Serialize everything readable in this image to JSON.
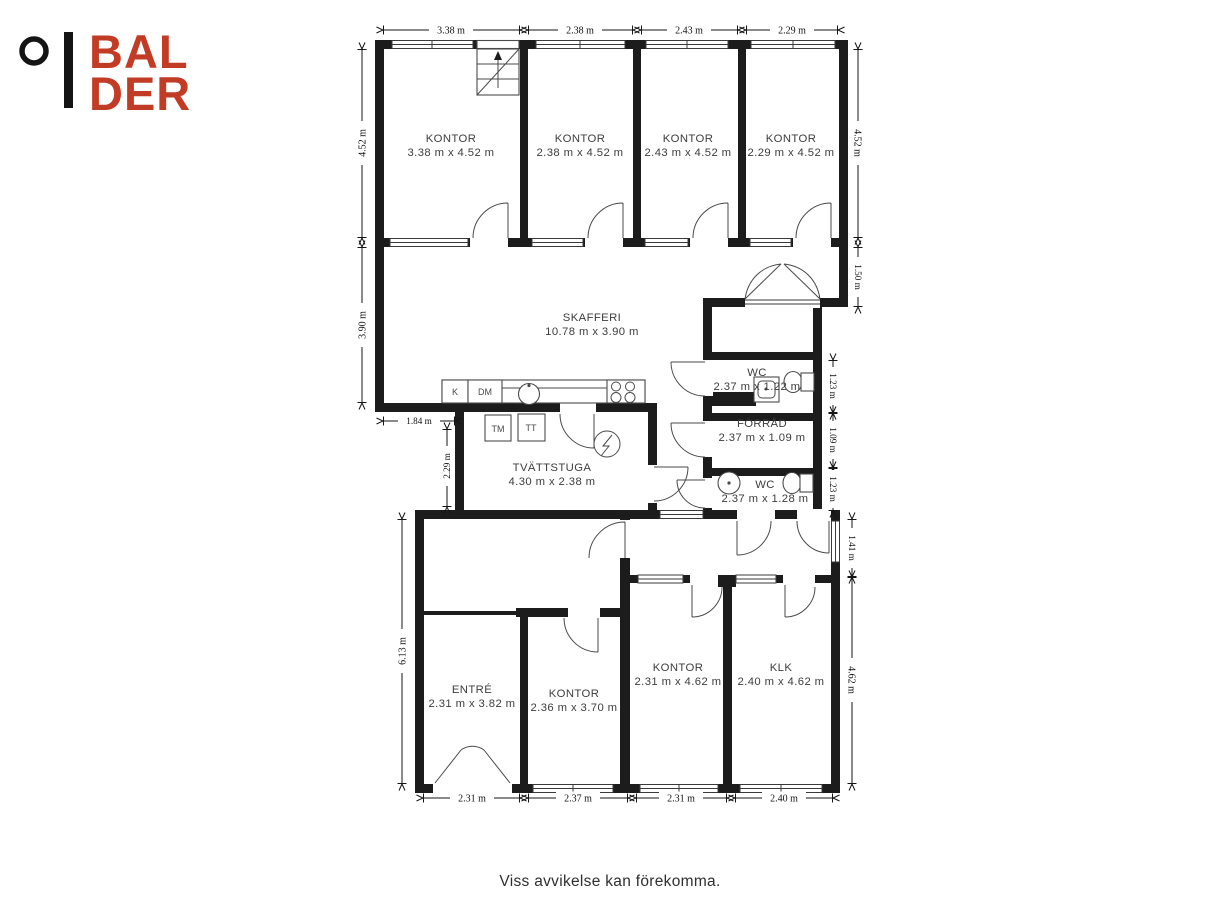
{
  "logo": {
    "line1": "BAL",
    "line2": "DER",
    "color": "#c23b25"
  },
  "footer": {
    "disclaimer": "Viss avvikelse kan förekomma."
  },
  "floorplan": {
    "rooms": [
      {
        "name": "KONTOR",
        "dims": "3.38 m x 4.52 m"
      },
      {
        "name": "KONTOR",
        "dims": "2.38 m x 4.52 m"
      },
      {
        "name": "KONTOR",
        "dims": "2.43 m x 4.52 m"
      },
      {
        "name": "KONTOR",
        "dims": "2.29 m x 4.52 m"
      },
      {
        "name": "SKAFFERI",
        "dims": "10.78 m x 3.90 m"
      },
      {
        "name": "WC",
        "dims": "2.37 m x 1.22 m"
      },
      {
        "name": "FÖRRÅD",
        "dims": "2.37 m x 1.09 m"
      },
      {
        "name": "TVÄTTSTUGA",
        "dims": "4.30 m x 2.38 m"
      },
      {
        "name": "WC",
        "dims": "2.37 m x 1.28 m"
      },
      {
        "name": "ENTRÉ",
        "dims": "2.31 m x 3.82 m"
      },
      {
        "name": "KONTOR",
        "dims": "2.36 m x 3.70 m"
      },
      {
        "name": "KONTOR",
        "dims": "2.31 m x 4.62 m"
      },
      {
        "name": "KLK",
        "dims": "2.40 m x 4.62 m"
      }
    ],
    "fixtures": {
      "fridge": "K",
      "dishwasher": "DM",
      "washing_machine": "TM",
      "tumble_dryer": "TT"
    },
    "dims_top": [
      "3.38 m",
      "2.38 m",
      "2.43 m",
      "2.29 m"
    ],
    "dims_bottom": [
      "2.31 m",
      "2.37 m",
      "2.31 m",
      "2.40 m"
    ],
    "dims_left": [
      "4.52 m",
      "3.90 m",
      "1.84 m",
      "2.29 m",
      "6.13 m"
    ],
    "dims_right": [
      "4.52 m",
      "1.50 m",
      "1.23 m",
      "1.09 m",
      "1.23 m",
      "1.41 m",
      "4.62 m"
    ]
  }
}
